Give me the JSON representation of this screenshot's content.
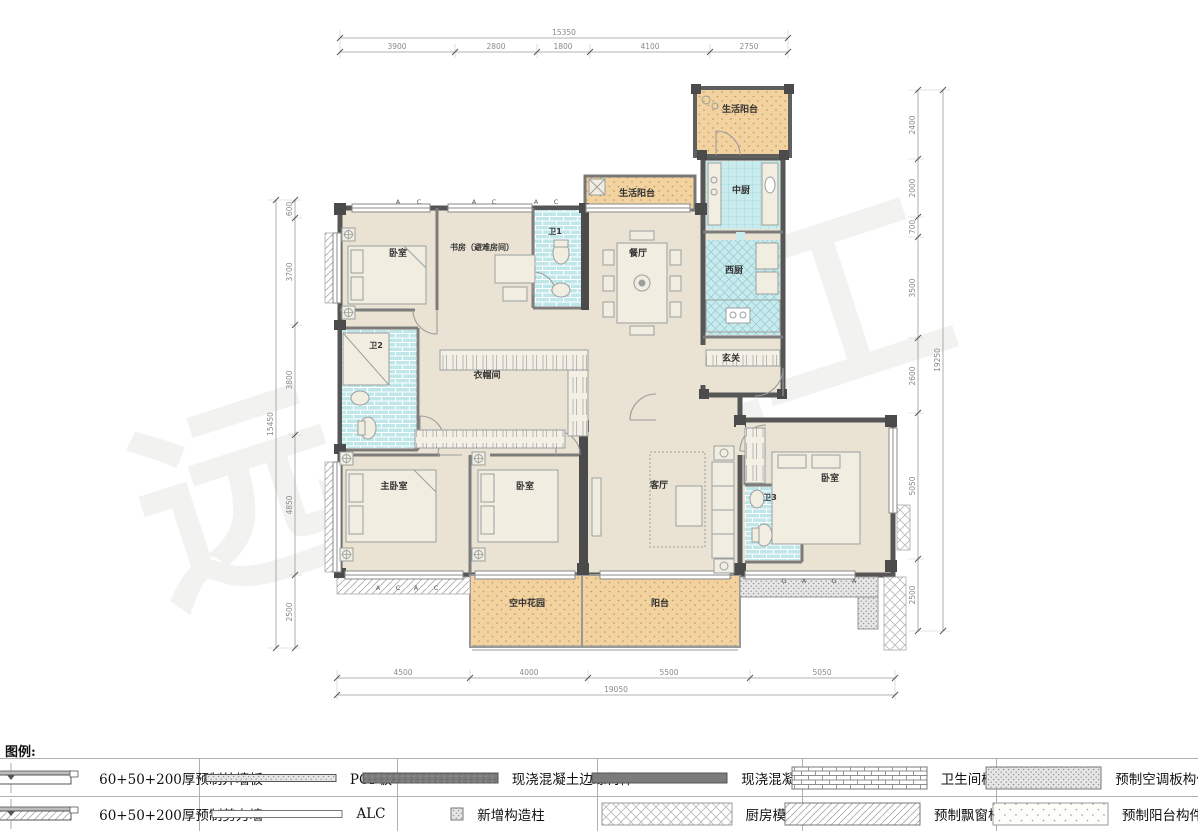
{
  "watermark": "远大住工",
  "plan": {
    "rooms": {
      "life_balcony_top": "生活阳台",
      "life_balcony_left": "生活阳台",
      "kitchen_middle": "中厨",
      "kitchen_west": "西厨",
      "dining": "餐厅",
      "study": "书房（避难房间）",
      "bath1": "卫1",
      "bath2": "卫2",
      "bath3": "卫3",
      "bedroom_top_left": "卧室",
      "foyer": "玄关",
      "closet": "衣帽间",
      "master_bedroom": "主卧室",
      "bedroom_middle": "卧室",
      "living": "客厅",
      "bedroom_right": "卧室",
      "sky_garden": "空中花园",
      "balcony": "阳台"
    },
    "wall_marks": {
      "top": [
        "A",
        "C",
        "A",
        "C",
        "A",
        "C"
      ],
      "bottom_left": [
        "A",
        "C",
        "A",
        "C"
      ],
      "bottom_right": [
        "G",
        "A",
        "G",
        "A"
      ]
    }
  },
  "dims": {
    "top": {
      "total": "15350",
      "segments": [
        "3900",
        "2800",
        "1800",
        "4100",
        "2750"
      ]
    },
    "left": {
      "total": "15450",
      "segments": [
        "600",
        "3700",
        "3800",
        "4850",
        "2500"
      ]
    },
    "right": {
      "total": "19250",
      "segments": [
        "2400",
        "2000",
        "700",
        "3500",
        "2600",
        "5050",
        "2500"
      ]
    },
    "bottom": {
      "total": "19050",
      "segments": [
        "4500",
        "4000",
        "5500",
        "5050"
      ]
    }
  },
  "legend": {
    "title": "图例:",
    "row1": [
      {
        "label": "60+50+200厚预制外墙板"
      },
      {
        "label": "PCF板"
      },
      {
        "label": "现浇混凝土边缘构件"
      },
      {
        "label": "现浇混凝土"
      },
      {
        "label": "卫生间模块"
      },
      {
        "label": "预制空调板构件"
      }
    ],
    "row2": [
      {
        "label": "60+50+200厚预制剪力墙"
      },
      {
        "label": "ALC"
      },
      {
        "label": "新增构造柱"
      },
      {
        "label": "厨房模块"
      },
      {
        "label": "预制飘窗构件"
      },
      {
        "label": "预制阳台构件"
      }
    ]
  }
}
